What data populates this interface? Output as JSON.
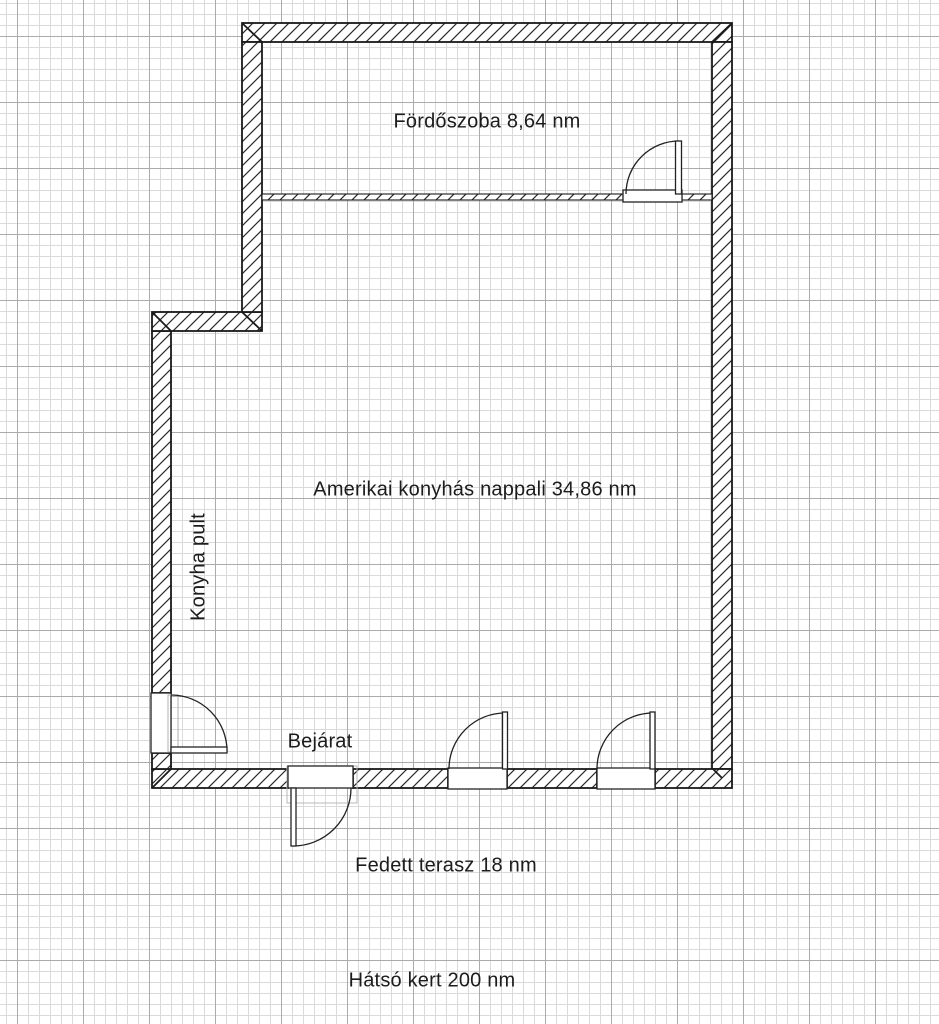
{
  "plan": {
    "labels": {
      "bathroom": "Fördőszoba 8,64 nm",
      "living_room": "Amerikai konyhás nappali 34,86 nm",
      "kitchen_counter": "Konyha pult",
      "entrance": "Bejárat",
      "terrace": "Fedett terasz 18 nm",
      "back_garden": "Hátsó kert 200 nm"
    }
  },
  "colors": {
    "paper": "#ffffff",
    "grid_minor": "#d9dadc",
    "grid_major": "#a9abad",
    "wall_outline": "#1a1a1a",
    "hatch": "#2b2b2b",
    "text": "#1c1c1c"
  }
}
